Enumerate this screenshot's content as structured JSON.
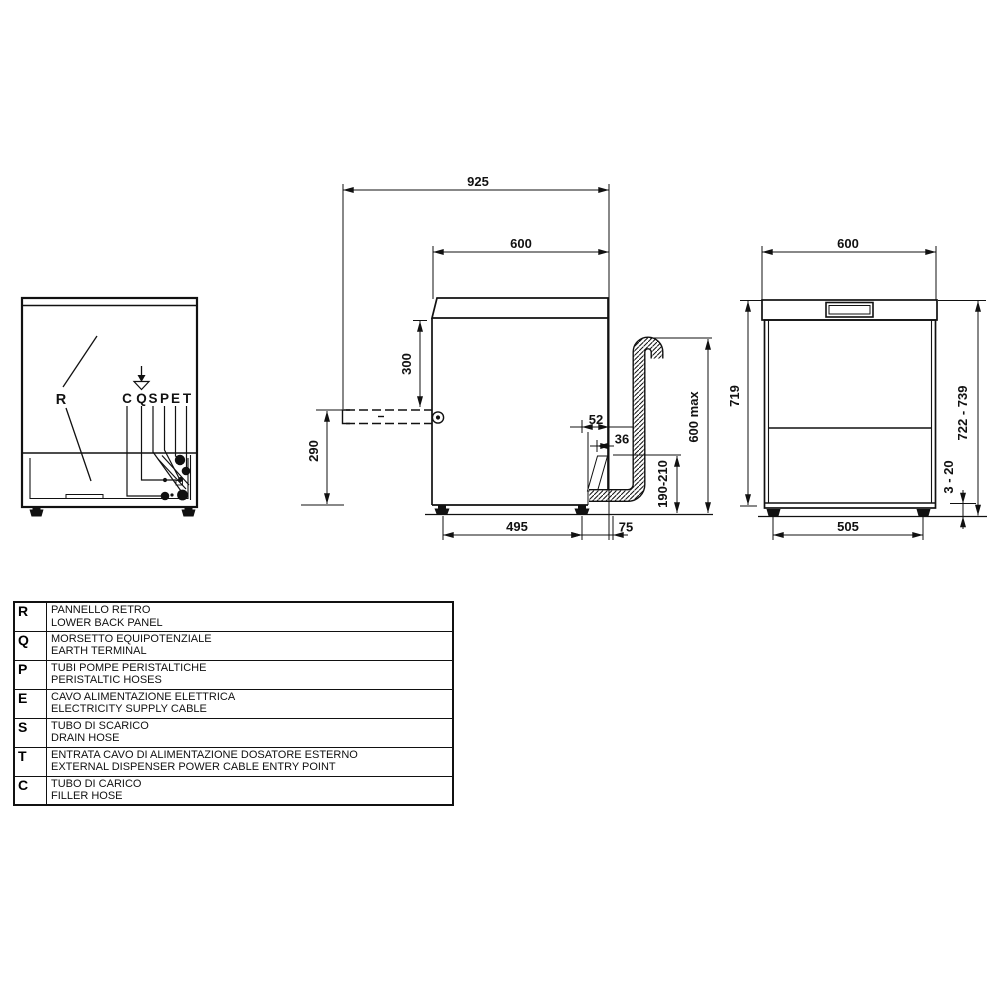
{
  "diagram": {
    "side_view": {
      "dim_total_depth_open": "925",
      "dim_body_depth": "600",
      "dim_door_drop": "300",
      "dim_door_to_floor": "290",
      "dim_drain_offset": "52",
      "dim_drain_stub": "36",
      "dim_drain_max_height": "600 max",
      "dim_drain_height_range": "190-210",
      "dim_feet_spacing": "495",
      "dim_rear_clearance": "75"
    },
    "front_view": {
      "dim_width": "600",
      "dim_body_height": "719",
      "dim_total_height_range": "722 - 739",
      "dim_foot_adjust_range": "3 - 20",
      "dim_feet_spacing": "505"
    },
    "rear_view": {
      "panel_label": "R",
      "connection_labels": [
        "C",
        "Q",
        "S",
        "P",
        "E",
        "T"
      ]
    }
  },
  "legend": {
    "rows": [
      {
        "key": "R",
        "it": "PANNELLO RETRO",
        "en": "LOWER BACK PANEL"
      },
      {
        "key": "Q",
        "it": "MORSETTO EQUIPOTENZIALE",
        "en": "EARTH TERMINAL"
      },
      {
        "key": "P",
        "it": "TUBI POMPE PERISTALTICHE",
        "en": "PERISTALTIC HOSES"
      },
      {
        "key": "E",
        "it": "CAVO ALIMENTAZIONE ELETTRICA",
        "en": "ELECTRICITY SUPPLY CABLE"
      },
      {
        "key": "S",
        "it": "TUBO DI SCARICO",
        "en": "DRAIN HOSE"
      },
      {
        "key": "T",
        "it": "ENTRATA CAVO DI ALIMENTAZIONE DOSATORE ESTERNO",
        "en": "EXTERNAL DISPENSER POWER CABLE ENTRY POINT"
      },
      {
        "key": "C",
        "it": "TUBO DI CARICO",
        "en": "FILLER HOSE"
      }
    ]
  }
}
